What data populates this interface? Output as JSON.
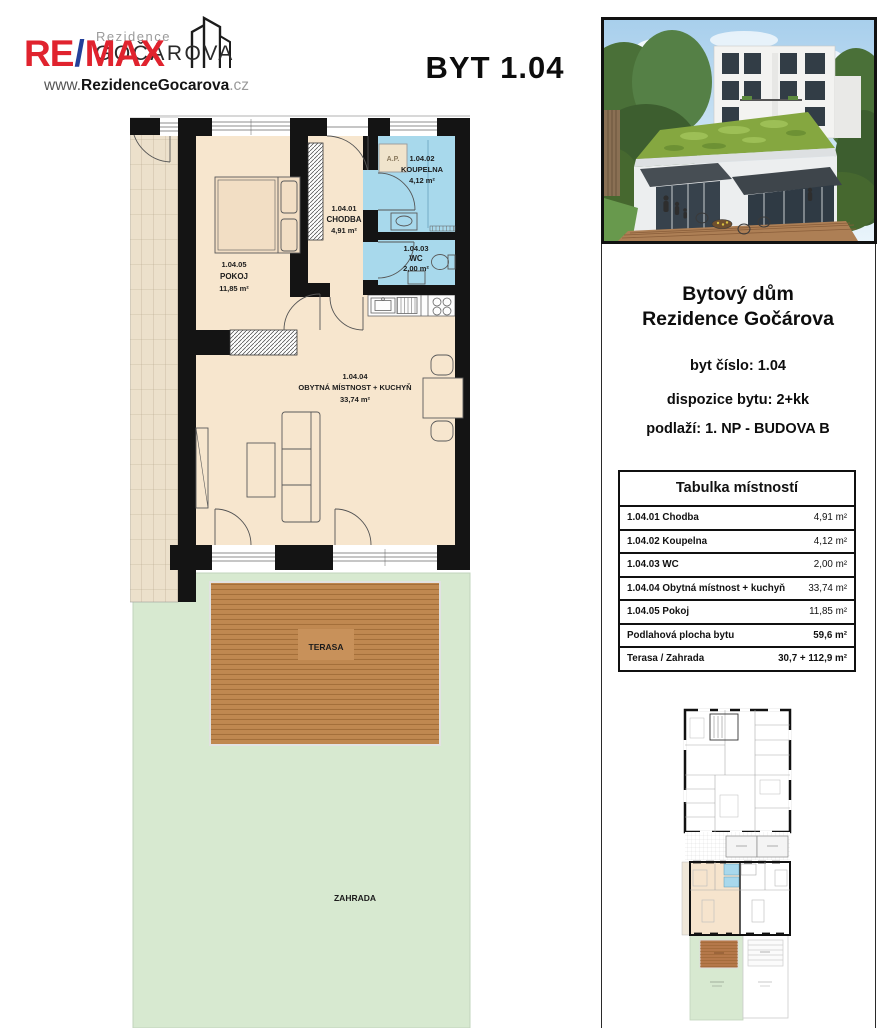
{
  "header": {
    "logo": {
      "remax_re": "RE",
      "remax_slash": "/",
      "remax_max": "MAX",
      "rezidence_small": "Rezidence",
      "gocarova": "GOČÁROVA",
      "website_www": "www.",
      "website_domain": "RezidenceGocarova",
      "website_tld": ".cz"
    },
    "title": "BYT 1.04"
  },
  "floorplan": {
    "rooms": [
      {
        "id": "1.04.01",
        "name": "CHODBA",
        "area": "4,91 m²"
      },
      {
        "id": "1.04.02",
        "name": "KOUPELNA",
        "area": "4,12 m²"
      },
      {
        "id": "1.04.03",
        "name": "WC",
        "area": "2,00 m²"
      },
      {
        "id": "1.04.04",
        "name": "OBYTNÁ MÍSTNOST + KUCHYŇ",
        "area": "33,74 m²"
      },
      {
        "id": "1.04.05",
        "name": "POKOJ",
        "area": "11,85 m²"
      }
    ],
    "labels": {
      "ap": "A.P.",
      "terasa": "TERASA",
      "zahrada": "ZAHRADA"
    },
    "colors": {
      "room_fill": "#f7e6ce",
      "wet_fill": "#a8d9ec",
      "terrace": "#c08850",
      "garden": "#d7e9d0",
      "wall": "#141414"
    }
  },
  "info_panel": {
    "building_title_line1": "Bytový dům",
    "building_title_line2": "Rezidence Gočárova",
    "unit_number": "byt číslo: 1.04",
    "layout": "dispozice bytu: 2+kk",
    "floor": "podlaží: 1. NP - BUDOVA B"
  },
  "room_table": {
    "title": "Tabulka místností",
    "rows": [
      {
        "label": "1.04.01 Chodba",
        "value": "4,91 m²"
      },
      {
        "label": "1.04.02 Koupelna",
        "value": "4,12 m²"
      },
      {
        "label": "1.04.03 WC",
        "value": "2,00 m²"
      },
      {
        "label": "1.04.04 Obytná místnost + kuchyň",
        "value": "33,74 m²"
      },
      {
        "label": "1.04.05 Pokoj",
        "value": "11,85 m²"
      },
      {
        "label": "Podlahová plocha bytu",
        "value": "59,6 m²"
      },
      {
        "label": "Terasa / Zahrada",
        "value": "30,7 + 112,9 m²"
      }
    ]
  }
}
